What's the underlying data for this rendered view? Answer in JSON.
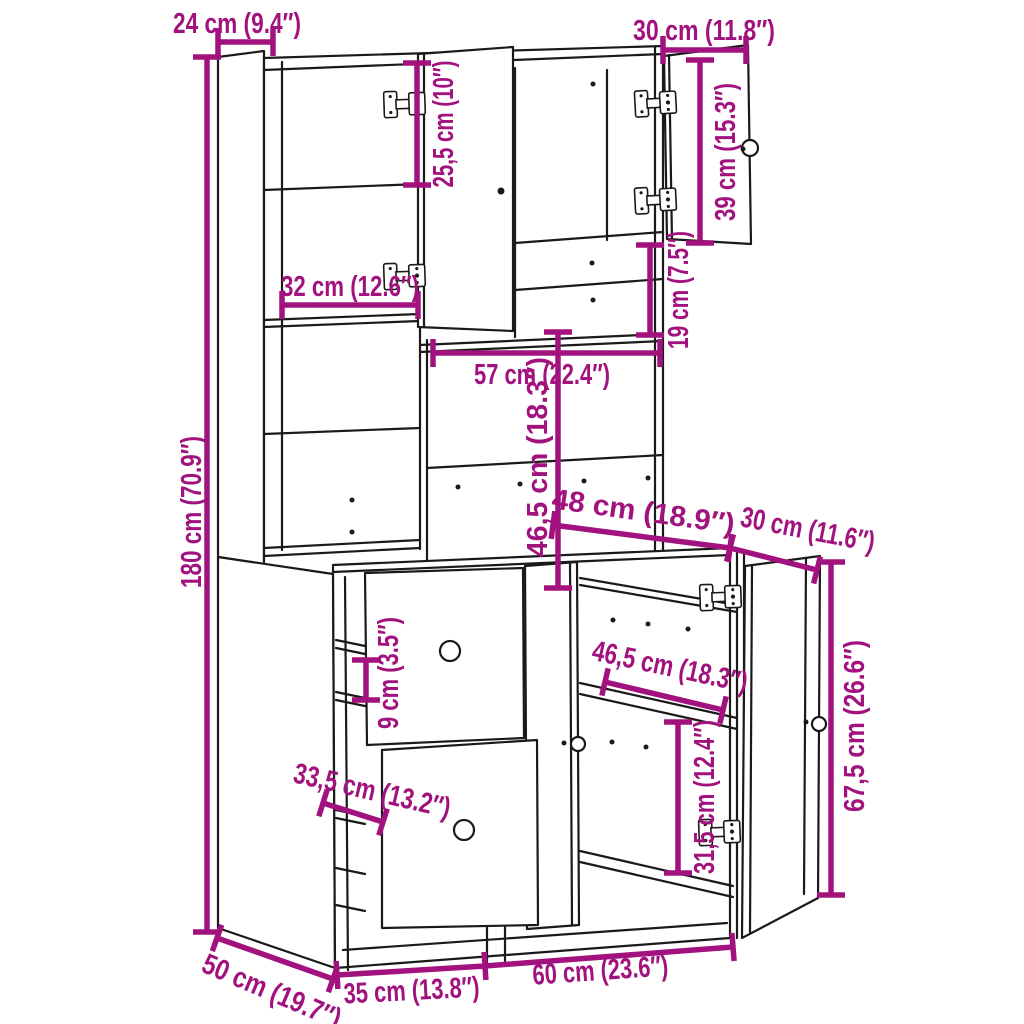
{
  "diagram": {
    "type": "furniture-dimension-diagram",
    "subject": "Kitchen highboard cabinet with open doors and drawers",
    "units": [
      "cm",
      "inches"
    ],
    "accent_color": "#A2127E",
    "line_color": "#1a1a1a",
    "background_color": "#ffffff",
    "dimensions": [
      {
        "id": "top-depth",
        "label": "24 cm (9.4″)"
      },
      {
        "id": "top-right-door-width",
        "label": "30 cm (11.8″)"
      },
      {
        "id": "upper-door-height",
        "label": "25,5 cm (10″)"
      },
      {
        "id": "right-door-height",
        "label": "39 cm (15.3″)"
      },
      {
        "id": "left-compartment-width",
        "label": "32 cm (12.6″)"
      },
      {
        "id": "right-compartment-height",
        "label": "19 cm (7.5″)"
      },
      {
        "id": "niche-width",
        "label": "57 cm (22.4″)"
      },
      {
        "id": "niche-height",
        "label": "46,5 cm (18.3″)"
      },
      {
        "id": "total-height",
        "label": "180 cm (70.9″)"
      },
      {
        "id": "base-top-width",
        "label": "48 cm (18.9″)"
      },
      {
        "id": "base-top-depth",
        "label": "30 cm (11.6″)"
      },
      {
        "id": "base-shelf-depth",
        "label": "46,5 cm (18.3″)"
      },
      {
        "id": "base-right-height",
        "label": "67,5 cm (26.6″)"
      },
      {
        "id": "drawer-height",
        "label": "9 cm (3.5″)"
      },
      {
        "id": "drawer-depth",
        "label": "33,5 cm (13.2″)"
      },
      {
        "id": "base-shelf-height",
        "label": "31,5 cm (12.4″)"
      },
      {
        "id": "base-depth",
        "label": "50 cm (19.7″)"
      },
      {
        "id": "base-left-width",
        "label": "35 cm (13.8″)"
      },
      {
        "id": "base-right-width",
        "label": "60 cm (23.6″)"
      }
    ]
  }
}
